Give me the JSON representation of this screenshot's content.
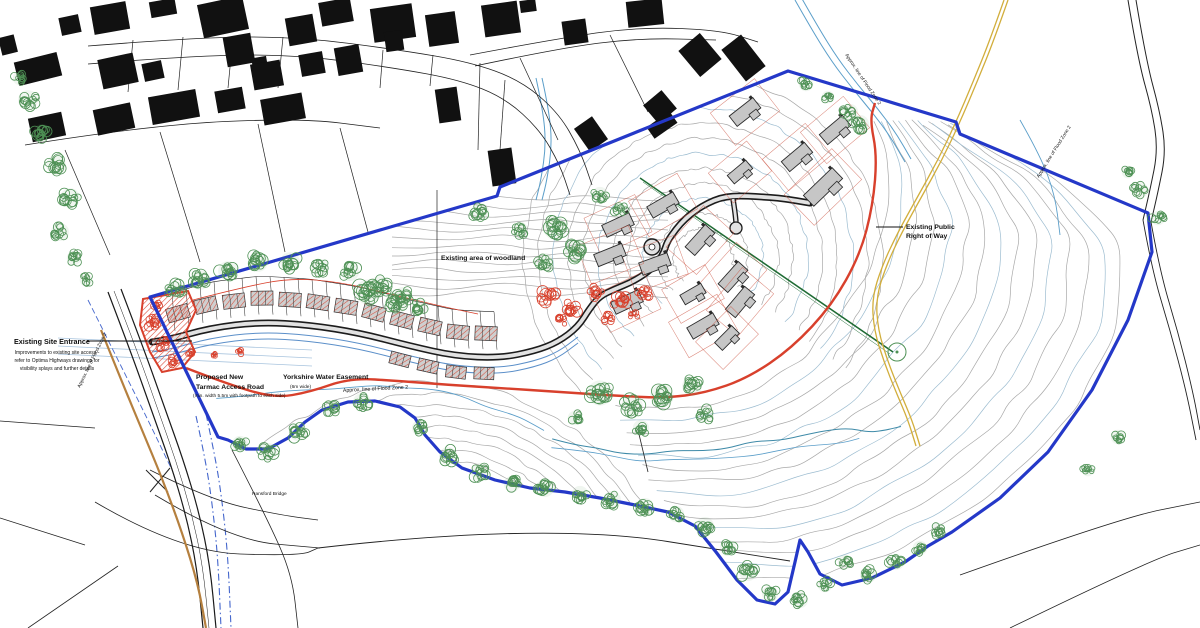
{
  "map": {
    "labels": {
      "site_entrance_title": "Existing Site Entrance",
      "site_entrance_line1": "Improvements to existing site access -",
      "site_entrance_line2": "refer to Optima Highways drawings for",
      "site_entrance_line3": "visibility splays and further details",
      "access_road_line1": "Proposed New",
      "access_road_line2": "Tarmac Access Road",
      "access_road_sub": "(min. width 5.5m with footpath to each side)",
      "easement_title": "Yorkshire Water Easement",
      "easement_sub": "(6m wide)",
      "woodland": "Existing area of woodland",
      "prow_line1": "Existing Public",
      "prow_line2": "Right of Way",
      "bridge": "Hansford Bridge",
      "flood_zone_bottom": "Approx. line of Flood Zone 2",
      "flood_zone_left": "Approx. line of Flood Zone 2",
      "flood_zone_right": "Approx. line of Flood Zone 2",
      "flood_zone_top": "Approx. line of Flood Zone 2"
    },
    "colors": {
      "site_boundary_blue": "#2438c8",
      "flood_line_cyan": "#5b9ec9",
      "flood_dash_blue": "#4466cc",
      "red_line": "#d8402c",
      "tree_green": "#4e9155",
      "hedgerow_green": "#1e6b33",
      "prow_yellow": "#d2ae3c",
      "contour_grey": "#a8a8a8",
      "contour_blue": "#9cbcd0",
      "road_black": "#1c1c1c",
      "building_black": "#111111",
      "house_grey": "#c6c6c6",
      "road_tan": "#b5803f",
      "water_easement_blue": "#5b8fc9"
    }
  }
}
